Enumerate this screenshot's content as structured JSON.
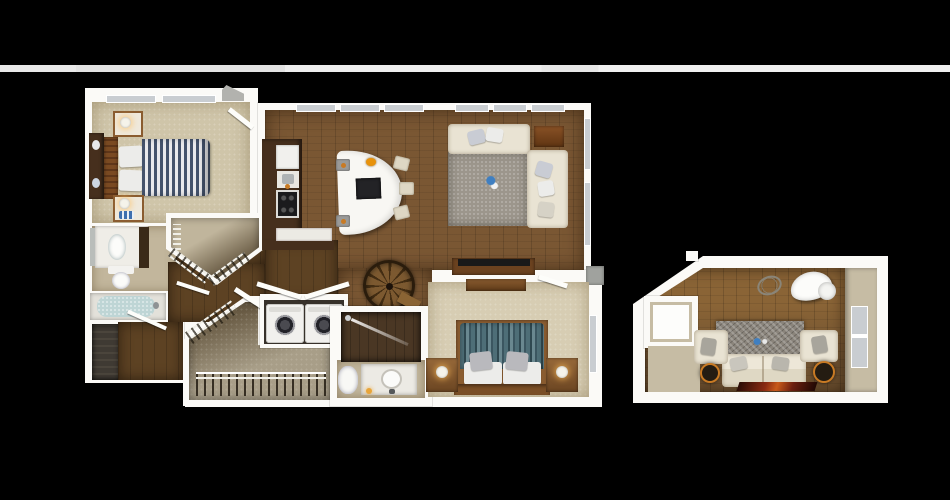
{
  "scene": {
    "type": "3d-floor-plan-render",
    "description": "Top-down 3D rendering of a two-bedroom apartment floor plan with a separate loft lounge plate on the right, on a black background",
    "background": "#000000",
    "page_band_color": "#ebebeb"
  },
  "colors": {
    "wall_white": "#fbfaf7",
    "interior_beige": "#c6bca4",
    "wood_floor": "#7a5733",
    "wood_dark": "#5d4223",
    "carpet": "#cfc5a9",
    "carpet2": "#d7cdb3",
    "bath_floor": "#c2b69c",
    "closet_dark": "#6a5c45",
    "closet_light": "#a89e88",
    "cabinet_brown": "#462f1d",
    "furn_wood": "#8a5c30",
    "island_white": "#f8f7f3",
    "sofa_cream": "#e9e3d3",
    "rug_gray": "#9c968c",
    "loft_rug": "#8a847b",
    "window_gray": "#c9cdd1",
    "entry_step_gray": "#a0a29e",
    "accent_orange": "#c87a24",
    "decor_blue": "#3f7fc1",
    "duvet1_navy": "#44526b",
    "duvet1_white": "#e9e9ec",
    "duvet2_teal": "#4e6e77",
    "duvet2_dark": "#2f4850",
    "stair_dark": "#432d13",
    "stair_light": "#7c5930",
    "runner_maroon": "#6b1f10",
    "appliance_white": "#f1f0ed",
    "water_blue": "#bed5d5"
  },
  "units": {
    "main_unit": {
      "name": "main-apartment-plate",
      "rooms": [
        {
          "name": "bedroom-1",
          "floor": "carpet",
          "furniture": [
            "striped-double-bed",
            "headboard",
            "dresser",
            "nightstand-with-lamp",
            "nightstand-with-lamp",
            "two-windows"
          ]
        },
        {
          "name": "bathroom-1",
          "floor": "tile",
          "furniture": [
            "vanity-with-sink",
            "mirror",
            "toilet",
            "bathtub"
          ]
        },
        {
          "name": "linen-shower-nook",
          "floor": "dark-tile",
          "furniture": []
        },
        {
          "name": "walk-in-closet-1",
          "floor": "carpet-over-dark",
          "furniture": [
            "wire-shelving"
          ]
        },
        {
          "name": "kitchen",
          "floor": "hardwood",
          "furniture": [
            "refrigerator",
            "sink-counter",
            "range-cooktop",
            "lower-cabinets",
            "curved-island",
            "bar-stools",
            "fruit-bowl"
          ]
        },
        {
          "name": "living-room",
          "floor": "hardwood",
          "furniture": [
            "sectional-sofa",
            "area-rug",
            "corner-side-table",
            "tv-console",
            "window-band"
          ]
        },
        {
          "name": "hallway",
          "floor": "hardwood",
          "furniture": [
            "spiral-staircase"
          ]
        },
        {
          "name": "laundry-closet",
          "floor": "dark",
          "furniture": [
            "washer",
            "dryer",
            "bifold-doors"
          ]
        },
        {
          "name": "walk-in-closet-2",
          "floor": "carpet",
          "furniture": [
            "wire-shelving-with-clothes"
          ]
        },
        {
          "name": "bathroom-2",
          "floor": "tile",
          "furniture": [
            "walk-in-shower",
            "toilet",
            "vanity-with-sink"
          ]
        },
        {
          "name": "bedroom-2",
          "floor": "carpet",
          "furniture": [
            "teal-striped-double-bed",
            "headboard",
            "nightstand-with-lamp",
            "nightstand-with-lamp",
            "dresser",
            "window"
          ]
        }
      ],
      "exterior": [
        "roof-vent",
        "entry-step"
      ]
    },
    "loft_unit": {
      "name": "loft-lounge-plate",
      "rooms": [
        {
          "name": "loft-lounge",
          "floor": "hardwood",
          "furniture": [
            "sofa",
            "armchair-left",
            "armchair-right",
            "stone-area-rug",
            "egg-chair",
            "wire-sphere-decor",
            "round-side-table",
            "round-side-table",
            "maroon-runner",
            "stair-opening-block",
            "window"
          ]
        }
      ]
    }
  }
}
